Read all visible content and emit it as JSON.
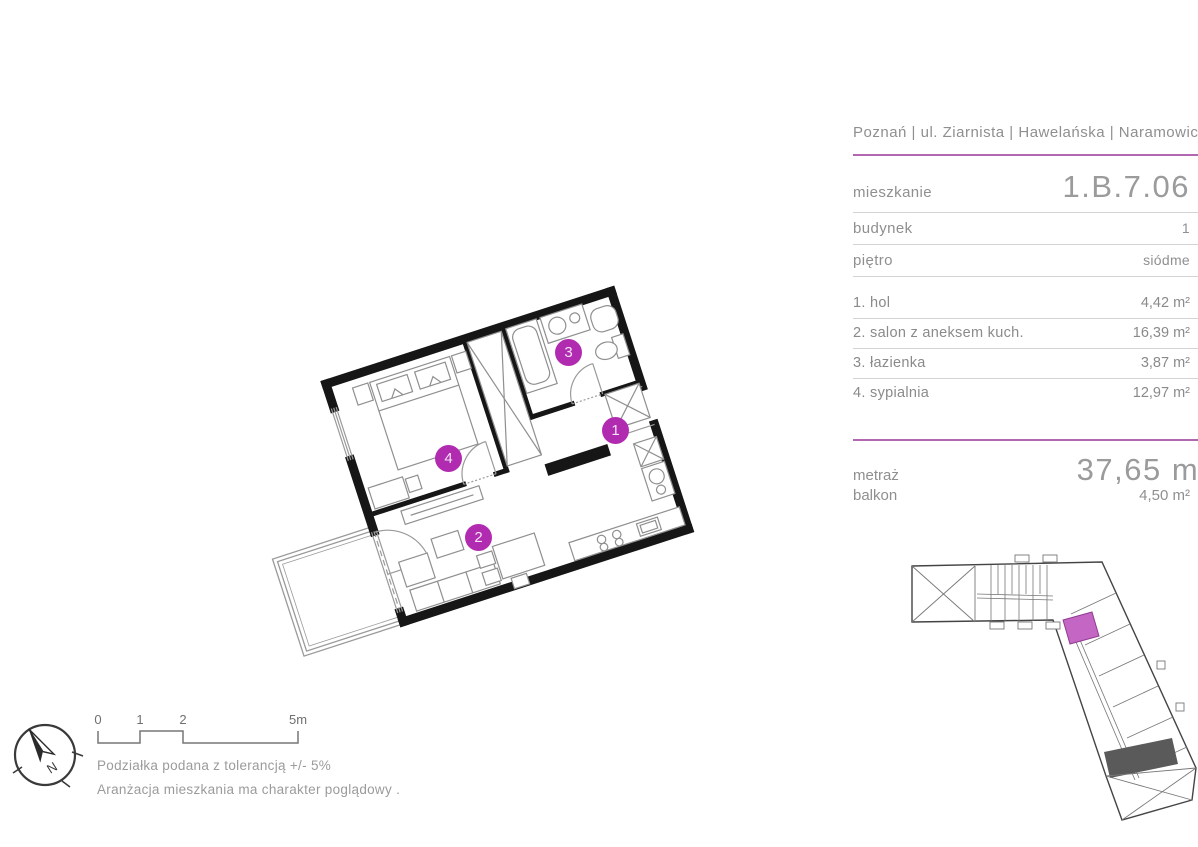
{
  "header": {
    "location": "Poznań | ul. Ziarnista | Hawelańska | Naramowicka"
  },
  "apartment": {
    "mieszkanie_label": "mieszkanie",
    "mieszkanie_value": "1.B.7.06",
    "budynek_label": "budynek",
    "budynek_value": "1",
    "pietro_label": "piętro",
    "pietro_value": "siódme"
  },
  "rooms": [
    {
      "name": "1. hol",
      "area": "4,42 m²"
    },
    {
      "name": "2. salon z aneksem kuch.",
      "area": "16,39 m²"
    },
    {
      "name": "3. łazienka",
      "area": "3,87 m²"
    },
    {
      "name": "4. sypialnia",
      "area": "12,97 m²"
    }
  ],
  "summary": {
    "metraz_label": "metraż",
    "metraz_value": "37,65 m²",
    "balkon_label": "balkon",
    "balkon_value": "4,50 m²"
  },
  "floorplan": {
    "room_numbers": [
      "1",
      "2",
      "3",
      "4"
    ]
  },
  "legend": {
    "compass_label": "N",
    "scale_ticks": [
      "0",
      "1",
      "2",
      "5m"
    ],
    "note_line1": "Podziałka podana z tolerancją +/- 5%",
    "note_line2": "Aranżacja mieszkania ma charakter poglądowy ."
  },
  "colors": {
    "accent_circle": "#b12bb1",
    "accent_line": "#b168b1",
    "highlight_unit": "#c466c4"
  }
}
